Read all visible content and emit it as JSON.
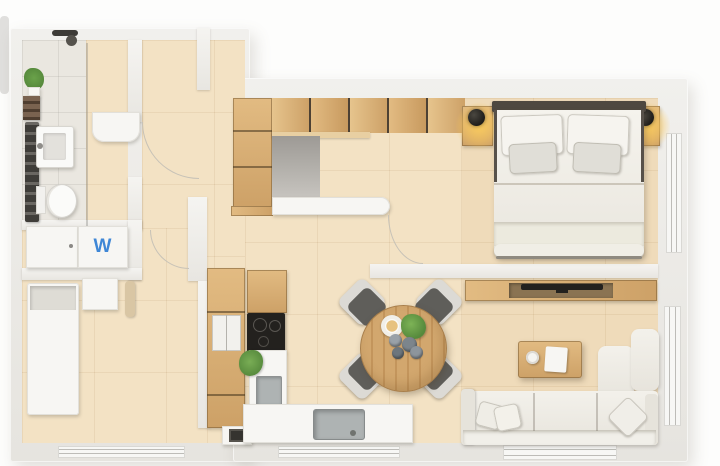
{
  "plan": {
    "type": "apartment-floor-plan-top-view",
    "labels": {
      "washer": "W"
    },
    "colors": {
      "floor": "#f3e2c4",
      "floor-bath": "#eae7e0",
      "wall": "#e9e7e2",
      "wood": "#cda167",
      "wood-dark": "#8a6a42",
      "dark": "#23211e",
      "accent": "#3f87d6",
      "cream": "#efece4",
      "chair": "#5f5e5a",
      "arc": "#c7c2b7",
      "plant": "#56893c",
      "sink": "#aeb3b3"
    },
    "rooms": [
      {
        "name": "bathroom"
      },
      {
        "name": "hallway"
      },
      {
        "name": "storage-room"
      },
      {
        "name": "kitchen"
      },
      {
        "name": "dining-area"
      },
      {
        "name": "bedroom"
      },
      {
        "name": "living-room"
      }
    ],
    "furniture": {
      "bathroom": [
        "shower",
        "plant",
        "shelf",
        "towel-radiator",
        "washbasin",
        "toilet",
        "wall-cabinet"
      ],
      "laundry": [
        "cabinet",
        "washing-machine"
      ],
      "storage-room": [
        "wardrobe",
        "storage-box",
        "radiator"
      ],
      "kitchen": [
        "tall-cabinet",
        "fridge",
        "cooktop",
        "plant",
        "prep-sink",
        "main-sink",
        "counter",
        "vent-unit"
      ],
      "hall-storage": [
        "tall-wardrobe",
        "upper-cabinet-row",
        "desk-area",
        "white-desk"
      ],
      "dining-area": [
        "round-table",
        "chair-nw",
        "chair-ne",
        "chair-sw",
        "chair-se",
        "cup",
        "plant",
        "bowls"
      ],
      "bedroom": [
        "double-bed",
        "headboard",
        "pillows",
        "nightstand-left",
        "nightstand-right",
        "lamp-left",
        "lamp-right",
        "window"
      ],
      "living-room": [
        "tv-console",
        "tv",
        "coffee-table",
        "laptop",
        "cup",
        "sofa",
        "chaise",
        "throw-pillows",
        "window"
      ]
    }
  }
}
